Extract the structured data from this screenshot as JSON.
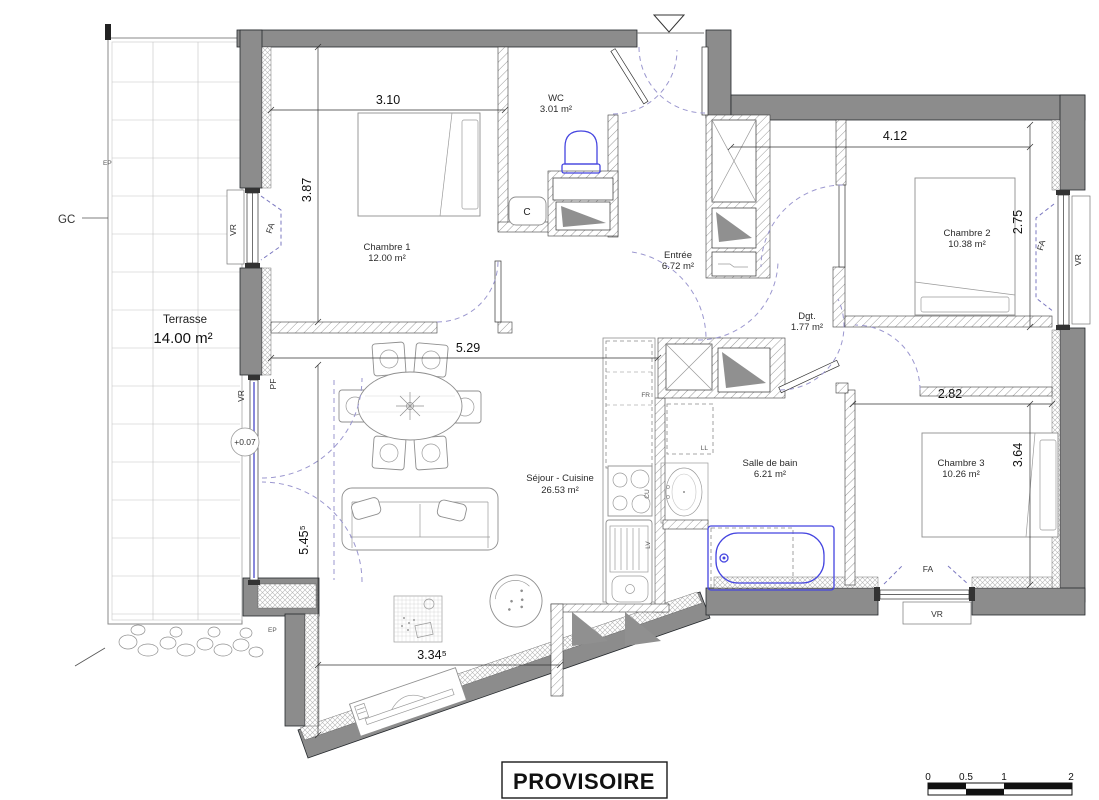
{
  "stamp": "PROVISOIRE",
  "rooms": {
    "terrasse": {
      "name": "Terrasse",
      "area": "14.00 m²"
    },
    "chambre1": {
      "name": "Chambre 1",
      "area": "12.00 m²"
    },
    "wc": {
      "name": "WC",
      "area": "3.01 m²"
    },
    "entree": {
      "name": "Entrée",
      "area": "6.72 m²"
    },
    "chambre2": {
      "name": "Chambre 2",
      "area": "10.38 m²"
    },
    "dgt": {
      "name": "Dgt.",
      "area": "1.77 m²"
    },
    "sejour": {
      "name": "Séjour - Cuisine",
      "area": "26.53 m²"
    },
    "sdb": {
      "name": "Salle de bain",
      "area": "6.21 m²"
    },
    "chambre3": {
      "name": "Chambre 3",
      "area": "10.26 m²"
    }
  },
  "dimensions": {
    "ch1_width": "3.10",
    "ch1_depth": "3.87",
    "ch2_width": "4.12",
    "ch2_depth": "2.75",
    "sejour_width": "5.29",
    "sejour_depth": "5.45⁵",
    "sejour_bottom": "3.34⁵",
    "ch3_width": "2.82",
    "ch3_depth": "3.64"
  },
  "annotations": {
    "gc": "GC",
    "ep": "EP",
    "level": "+0.07",
    "pf": "PF",
    "fa": "FA",
    "vr": "VR",
    "fr": "FR",
    "cu": "CU",
    "lv": "LV",
    "ll": "LL",
    "c": "C"
  },
  "scale_bar": {
    "ticks": [
      "0",
      "0.5",
      "1",
      "2"
    ]
  },
  "colors": {
    "wall": "#8c8c8c",
    "fixture_blue": "#4545e0",
    "door_arc": "#9b97cf",
    "glazing": "#6b6bd0"
  }
}
